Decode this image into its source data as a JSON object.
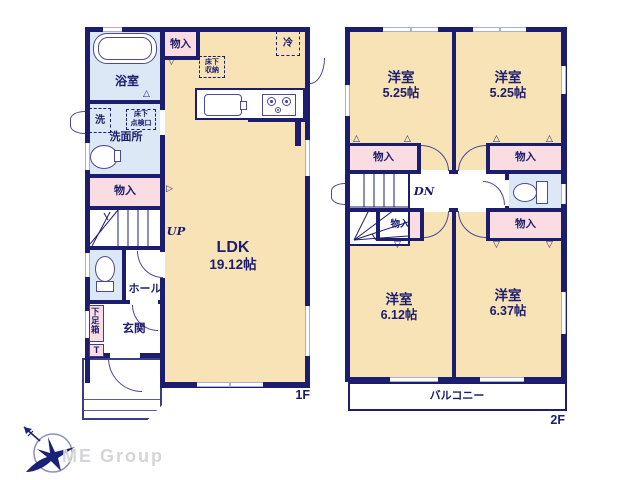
{
  "colors": {
    "wall": "#1d1d6e",
    "line": "#4a4a96",
    "room_cream": "#f8e3b6",
    "closet_pink": "#fadde2",
    "wet_blue": "#dce8f5",
    "window_gray": "#a9b0d4",
    "logo_navy": "#1a2277",
    "logo_gray": "#d5d5d7"
  },
  "floor1": {
    "label": "1F",
    "bath": "浴室",
    "washroom": "洗面所",
    "washer": "洗",
    "hatch_l1": "床下",
    "hatch_l2": "点検口",
    "closet_top": "物入",
    "closet_mid": "物入",
    "ufs_l1": "床下",
    "ufs_l2": "収納",
    "fridge": "冷",
    "ldk_name": "LDK",
    "ldk_size": "19.12帖",
    "up": "UP",
    "hall": "ホール",
    "entrance": "玄関",
    "shoebox": "下足箱",
    "shoebox_t": "T"
  },
  "floor2": {
    "label": "2F",
    "room_tl_name": "洋室",
    "room_tl_size": "5.25帖",
    "room_tr_name": "洋室",
    "room_tr_size": "5.25帖",
    "room_bl_name": "洋室",
    "room_bl_size": "6.12帖",
    "room_br_name": "洋室",
    "room_br_size": "6.37帖",
    "closet_tl": "物入",
    "closet_tr": "物入",
    "closet_small": "物入",
    "closet_br": "物入",
    "dn": "DN",
    "balcony": "バルコニー"
  },
  "logo": {
    "company": "ME Group"
  }
}
